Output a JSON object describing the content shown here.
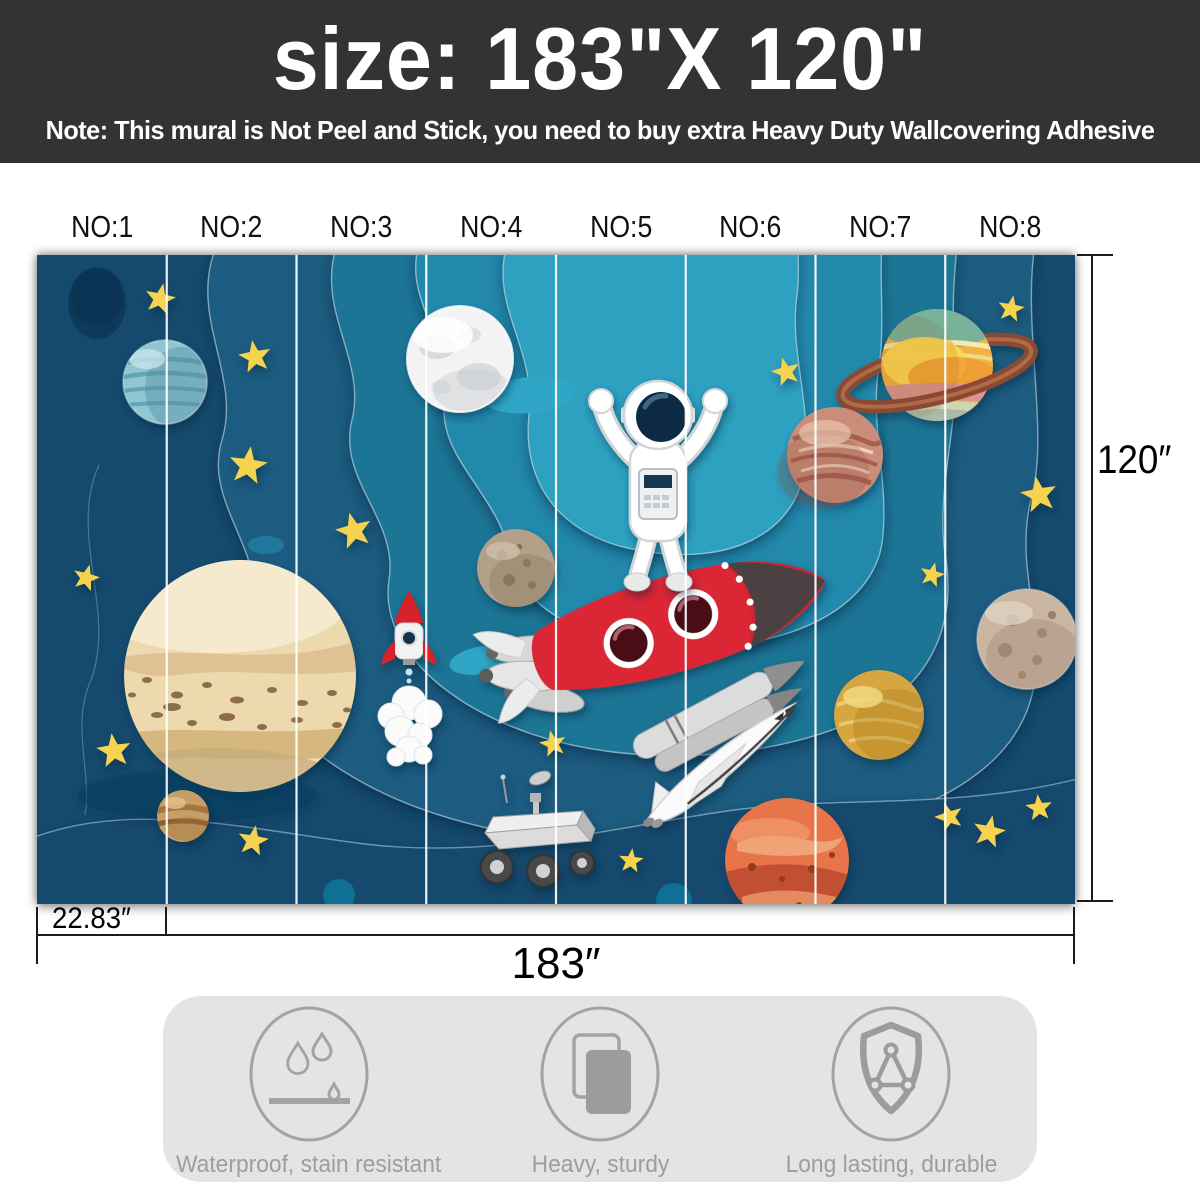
{
  "header": {
    "size_label": "size:  183\"X 120\"",
    "note": "Note: This mural is Not Peel and Stick, you need to buy extra Heavy Duty Wallcovering Adhesive",
    "bg_color": "#333333",
    "text_color": "#ffffff"
  },
  "panels": {
    "count": 8,
    "labels": [
      "NO:1",
      "NO:2",
      "NO:3",
      "NO:4",
      "NO:5",
      "NO:6",
      "NO:7",
      "NO:8"
    ]
  },
  "dimensions": {
    "panel_width": "22.83″",
    "total_width": "183″",
    "height": "120″"
  },
  "features": [
    {
      "icon": "waterproof-icon",
      "label": "Waterproof, stain resistant"
    },
    {
      "icon": "heavy-sturdy-icon",
      "label": "Heavy, sturdy"
    },
    {
      "icon": "shield-icon",
      "label": "Long lasting, durable"
    }
  ],
  "mural": {
    "theme": "paper-cut style outer space kids wall mural",
    "elements": [
      "astronaut",
      "red-rocket",
      "space-shuttle",
      "small-rocket",
      "mars-rover",
      "moon",
      "saturn",
      "jupiter",
      "mars",
      "striped-teal-planet",
      "golden-planet",
      "rocky-planets",
      "yellow-stars"
    ],
    "colors": {
      "background_navy": "#154a6e",
      "teal_layers": [
        "#1a5c80",
        "#1f7495",
        "#2389ac",
        "#2da0c0"
      ],
      "star_yellow": "#f6d34f",
      "divider_line": "#ffffff"
    }
  }
}
